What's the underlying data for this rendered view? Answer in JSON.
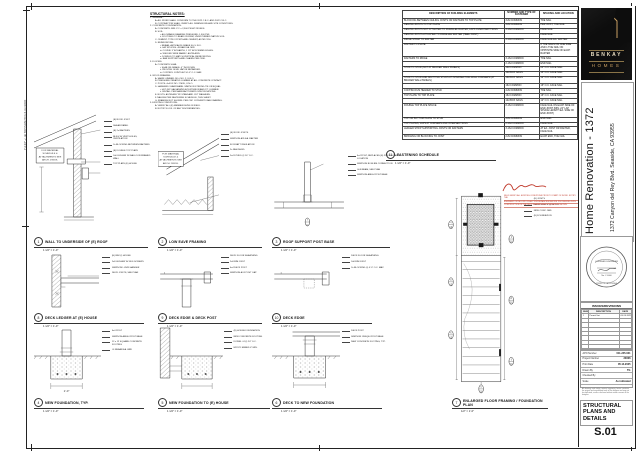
{
  "sheet": {
    "notes_heading": "STRUCTURAL NOTES:",
    "dim_label": "7'-2 3/4\" +/- (E) TOP PLATE TO U.S. (E) ROOF",
    "notes_lines": [
      [
        0,
        "1.  GENERAL:"
      ],
      [
        1,
        "A.  ALL WORK SHALL CONFORM TO THE 2022 C.B.C. AND 2022 C.R.C."
      ],
      [
        1,
        "B.  CONTRACTOR SHALL VERIFY ALL DIMENSIONS AND SITE CONDITIONS."
      ],
      [
        0,
        "2.  CONCRETE / FOUNDATION:"
      ],
      [
        1,
        "A.  CONCRETE: MIN. F'C = 2,500 PSI AT 28 DAYS."
      ],
      [
        1,
        "B.  SOIL:"
      ],
      [
        2,
        "i.   ALLOWABLE BEARING PRESSURE: 1,500 PSF."
      ],
      [
        2,
        "ii.  FOOTINGS TO BEAR ON FIRM, UNDISTURBED NATIVE SOIL."
      ],
      [
        1,
        "C.  CEMENT: TYPE II PORTLAND CEMENT, ASTM C150."
      ],
      [
        1,
        "D.  REINFORCING:"
      ],
      [
        2,
        "i.   REBAR: ASTM A615 GRADE 60, U.N.O."
      ],
      [
        2,
        "ii.  LAP SPLICES: 48 BAR DIA. MIN."
      ],
      [
        2,
        "iii. COVER: 3\" AT EARTH, 1 1/2\" AT FORMED EDGES."
      ],
      [
        2,
        "iv.  WELDED WIRE FABRIC: ASTM A185."
      ],
      [
        2,
        "v.   DOWELS TO MATCH VERTICAL REINFORCING."
      ],
      [
        2,
        "vi.  BAR SUPPORTS AND CHAIRS PER CRSI."
      ],
      [
        0,
        "3.  FLOORS:"
      ],
      [
        1,
        "A.  CONCRETE SLAB:"
      ],
      [
        2,
        "i.   SLAB ON GRADE: 4\" THICK MIN."
      ],
      [
        2,
        "ii.  PROVIDE 10 MIL VAPOR RETARDER."
      ],
      [
        2,
        "iii. CONTROL JOINTS AT 10'-0\" O.C. MAX."
      ],
      [
        0,
        "4.  WOOD FRAMING:"
      ],
      [
        1,
        "A.  SAWN LUMBER: DF-L NO. 2, U.N.O."
      ],
      [
        1,
        "B.  PRESSURE-TREATED LUMBER AT ALL CONCRETE CONTACT."
      ],
      [
        1,
        "C.  POSTS: 4x4 DF NO. 2 MIN., U.N.O."
      ],
      [
        1,
        "D.  HANGERS / HARDWARE: SIMPSON STRONG-TIE OR EQUAL."
      ],
      [
        2,
        "i.   HOT-DIP GALVANIZED AT EXTERIOR AND P.T. LUMBER."
      ],
      [
        2,
        "ii.  INSTALL PER MANUFACTURER'S SPECIFICATIONS."
      ],
      [
        1,
        "E.  BOLTS: ASTM A307 W/ STANDARD CUT WASHERS."
      ],
      [
        1,
        "F.  NAILING PER FASTENING SCHEDULE, THIS SHEET."
      ],
      [
        1,
        "G.  FRAMING NOT SHOWN: PER CRC CONVENTIONAL FRAMING."
      ],
      [
        0,
        "5.  EXISTING CONDITIONS:"
      ],
      [
        1,
        "A.  VERIFY ALL (E) MEMBER SIZES IN FIELD."
      ],
      [
        1,
        "B.  NOTIFY E.O.R. OF ANY DISCREPANCIES."
      ]
    ]
  },
  "schedule": {
    "title_no": "11",
    "title": "FASTENING SCHEDULE",
    "scale": "1 1/2\" = 1'-0\"",
    "columns": [
      "DESCRIPTION OF BUILDING ELEMENTS",
      "NUMBER AND TYPE OF FASTENER",
      "SPACING AND LOCATION"
    ],
    "rows": [
      [
        "BLOCKING BETWEEN CEILING JOISTS OR RAFTERS TO TOP PLATE",
        "3-8d COMMON",
        "TOE NAIL"
      ],
      [
        "CEILING JOISTS TO TOP PLATE",
        "3-8d COMMON",
        "PER JOIST, TOE NAIL"
      ],
      [
        "CEILING JOISTS NOT ATTACHED TO PARALLEL RAFTER, LAPS OVER PARTITIONS",
        "3-16d COMMON",
        "FACE NAIL"
      ],
      [
        "CEILING JOISTS ATTACHED TO PARALLEL RAFTER (HEEL JOINT)",
        "",
        "FACE NAIL"
      ],
      [
        "RIDGE STRAP TO RAFTER",
        "3-10d COMMON",
        "FACE NAIL EA. RAFTER"
      ],
      [
        "RAFTER TO PLATE",
        "",
        "2 TOE NAILS ON ONE SIDE AND 1 TOE NAIL ON OPPOSITE SIDE OF EACH RAFTER"
      ],
      [
        "RAFTERS TO RIDGE",
        "3-16d COMMON",
        "TOE NAIL"
      ],
      [
        "",
        "2-16d COMMON",
        "END NAIL"
      ],
      [
        "STUD TO STUD (NOT AT BRACED WALL PANELS)",
        "16d COMMON",
        "24\" O.C. FACE NAIL"
      ],
      [
        "",
        "10d BOX NAILS",
        "16\" O.C. FACE NAIL"
      ],
      [
        "STUD TO STUD AND ABUTTING STUDS AT INTERSECTING WALL CORNERS (AT BRACED WALL PANELS)",
        "16d BOX NAILS",
        "12\" O.C. FACE NAIL"
      ],
      [
        "",
        "16d COMMON",
        "16\" O.C. FACE NAIL"
      ],
      [
        "CONTINUOUS HEADER TO STUD",
        "4-8d COMMON",
        "TOE NAIL"
      ],
      [
        "TOP PLATE TO TOP PLATE",
        "16d COMMON",
        "16\" O.C. FACE NAIL"
      ],
      [
        "",
        "10d BOX NAILS",
        "12\" O.C. FACE NAIL"
      ],
      [
        "DOUBLE TOP PLATE SPLICE",
        "8-16d COMMON",
        "FACE NAIL ON EACH SIDE OF END JOINT (MIN. 24\" LAP SPLICE LENGTH EA. SIDE OF END JOINT)"
      ],
      [
        "TOP OR BOTTOM PLATE TO STUD",
        "4-8d COMMON",
        "END NAIL"
      ],
      [
        "TOP PLATES, LAPS AT CORNERS AND INTERSECTIONS",
        "2-16d COMMON",
        "FACE NAIL"
      ],
      [
        "LEDGER STRIP SUPPORTING JOISTS OR RAFTERS",
        "3-16d COMMON",
        "AT EA. JOIST OR RAFTER, FACE NAIL"
      ],
      [
        "BRIDGING OR BLOCKING TO JOIST",
        "2-8d COMMON",
        "EACH END, TOE NAIL"
      ]
    ]
  },
  "details": [
    {
      "no": "1",
      "title": "WALL TO UNDERSIDE OF (E) ROOF",
      "scale": "1 1/2\" = 1'-0\"",
      "kind": "roofwall",
      "note_lines": [
        "FOR MATERIAL",
        "SCHEDULE &",
        "ATTACHMENTS SEE",
        "ARCH. DWGS."
      ],
      "callouts": [
        "(E) ROOF JOIST",
        "SHEAR PANEL",
        "(E) 2x RAFTERS",
        "BLKG W/ VENT HOLES, VENTILATION",
        "2x BLOCKING BETWEEN RAFTERS",
        "(E) DOUBLE TOP PLATE",
        "2x6 LEDGER W/ BALLOON FRAMED WALL",
        "TOP PLATE (E) HOUSE"
      ]
    },
    {
      "no": "2",
      "title": "LOW EAVE FRAMING",
      "scale": "1 1/2\" = 1'-0\"",
      "kind": "eave",
      "note_lines": [
        "FOR MATERIAL",
        "SCHEDULE &",
        "ATTACHMENTS SEE",
        "ARCH. DWGS."
      ],
      "callouts": [
        "(E) ROOF JOISTS",
        "SIMPSON A35 EA. RAFTER",
        "R-19 BATT INSULATION",
        "2x FASCIA BD.",
        "2x4 STUDS @ 16\" O.C."
      ]
    },
    {
      "no": "3",
      "title": "ROOF SUPPORT POST BASE",
      "scale": "1 1/2\" = 1'-0\"",
      "kind": "postbase",
      "note_lines": [],
      "callouts": [
        "4x4 POST, REPLACES (E) POST IN SAME LOCATION",
        "SIMPSON BC46 BM CONNECTION",
        "GLB BEAM, SEE PLAN",
        "SIMPSON ABU44 POST BASE"
      ]
    },
    {
      "no": "8",
      "title": "DECK LEDGER AT (E) HOUSE",
      "scale": "1 1/2\" = 1'-0\"",
      "kind": "ledger",
      "note_lines": [],
      "callouts": [
        "(E) RIM @ HOUSE",
        "2x8 LEDGER W/ SDS SCREWS",
        "SIMPSON LUS28 HANGER",
        "DECK JOISTS, SEE PLAN"
      ]
    },
    {
      "no": "9",
      "title": "DECK EDGE & DECK POST",
      "scale": "1 1/2\" = 1'-0\"",
      "kind": "deckpost",
      "note_lines": [],
      "callouts": [
        "DECK FLOOR SHEATHING",
        "2x8 RIM JOIST",
        "4x4 DECK POST",
        "SIMPSON AC4 POST CAP"
      ]
    },
    {
      "no": "10",
      "title": "DECK EDGE",
      "scale": "1 1/2\" = 1'-0\"",
      "kind": "deckedge",
      "note_lines": [],
      "callouts": [
        "DECK FLOOR SHEATHING",
        "2x8 RIM JOIST",
        "2x BLOCKING @ 4'-0\" O.C. MAX"
      ]
    },
    {
      "no": "4",
      "title": "NEW FOUNDATION, TYP.",
      "scale": "1 1/2\" = 1'-0\"",
      "kind": "footing",
      "note_lines": [],
      "callouts": [
        "4x4 POST",
        "SIMPSON ABU44 POST BASE",
        "12 x 12 SQUARE CONCRETE FOOTING",
        "#4 REBAR EA. WAY"
      ]
    },
    {
      "no": "5",
      "title": "NEW FOUNDATION TO (E) HOUSE",
      "scale": "1 1/2\" = 1'-0\"",
      "kind": "footing2",
      "note_lines": [],
      "callouts": [
        "(E) HOUSE FOUNDATION",
        "NEW CONCRETE FOOTING",
        "DOWEL #4 @ 24\" O.C.",
        "EPOXY EMBED 4\" MIN."
      ]
    },
    {
      "no": "6",
      "title": "DECK TO NEW FOUNDATION",
      "scale": "1 1/2\" = 1'-0\"",
      "kind": "footing3",
      "note_lines": [],
      "callouts": [
        "DECK POST",
        "SIMPSON CBSQ44 POST BASE",
        "NEW CONCRETE FOOTING, TYP."
      ]
    },
    {
      "no": "7",
      "title": "ENLARGED FLOOR FRAMING / FOUNDATION PLAN",
      "scale": "1/2\" = 1'-0\"",
      "kind": "plan",
      "note_lines": [],
      "callouts": [
        "(E) JOISTS",
        "DECK JOISTS @ 16\" O.C.",
        "NEW CONC. PAD",
        "(E) FOUNDATION"
      ]
    }
  ],
  "plan_overlay": {
    "red_lines": [
      "FIELD VERIFY ALL EXISTING CONDITIONS PRIOR TO START OF WORK. NOTIFY THE",
      "ENGINEER OF RECORD OF ANY DISCREPANCIES BEFORE PROCEEDING WITH",
      "CONSTRUCTION OF THE DECK FRAMING AND FOUNDATION SHOWN."
    ]
  },
  "titleblock": {
    "logo_line1": "BENKAY",
    "logo_line2": "HOMES",
    "project_title": "Home Renovation - 1372",
    "project_address": "1372 Canyon del Rey Blvd.  Seaside, CA 93955",
    "stamp_name": "LICENSED ENGINEER",
    "stamp_line2": "No. C 0000",
    "stamp_line3": "STATE OF CALIFORNIA",
    "revisions": {
      "title": "ISSUES/REVISIONS",
      "columns": [
        "NUM",
        "DESCRIPTION",
        "DATE"
      ],
      "rows": [
        [
          "1",
          "Permit Set",
          "05.24.2025"
        ]
      ],
      "empty_rows": 7
    },
    "fields": [
      [
        "APN Number",
        "011-245-021"
      ],
      [
        "Project Number",
        "23006"
      ],
      [
        "Print Date",
        "05.14.2025"
      ],
      [
        "Drawn By",
        "TG"
      ],
      [
        "Checked By",
        ""
      ],
      [
        "Scale",
        "As indicated"
      ]
    ],
    "disclaimer": "All drawings and written material appearing herein constitute the original and unpublished work of the designer and may not be duplicated, used or disclosed without written consent of the designer.",
    "sheet_title": "STRUCTURAL PLANS AND DETAILS",
    "sheet_number": "S.01"
  }
}
